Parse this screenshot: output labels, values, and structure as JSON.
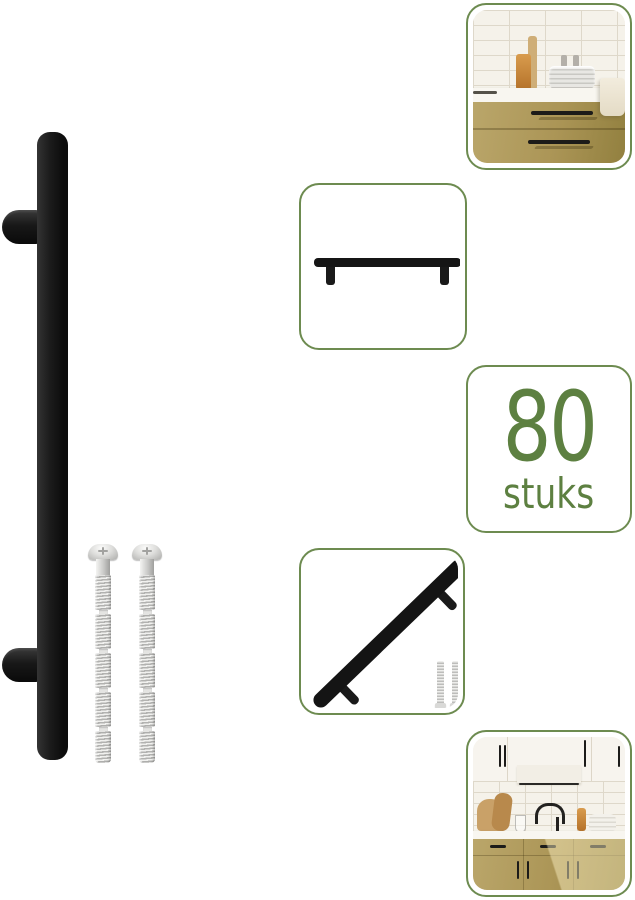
{
  "badge": {
    "quantity": "80",
    "unit": "stuks"
  },
  "colors": {
    "accent_green": "#6d8b50",
    "badge_text": "#5d8041",
    "handle_black": "#161616",
    "cabinet_gold": "#ab9556",
    "tile_white": "#f5f2ea",
    "counter_white": "#f8f6f0",
    "screw_silver": "#d7d7d5",
    "background": "#ffffff"
  }
}
